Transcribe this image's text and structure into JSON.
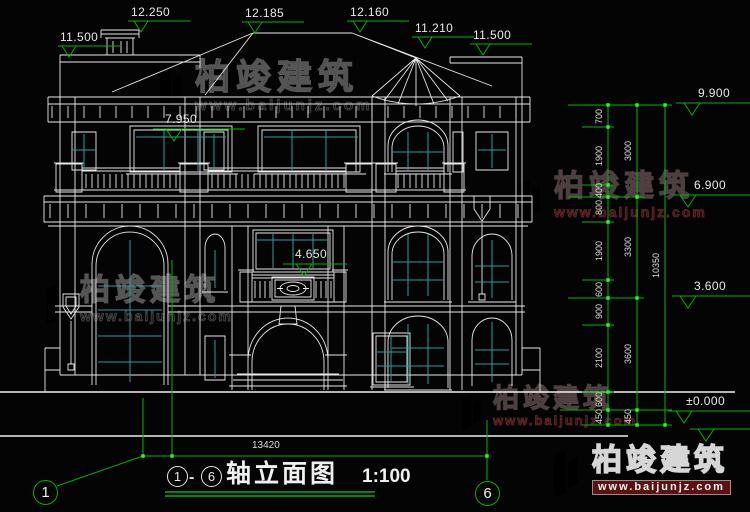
{
  "drawing": {
    "title": {
      "axis_start": "1",
      "separator": "-",
      "axis_end": "6",
      "text": "轴立面图",
      "scale": "1:100"
    },
    "axes": {
      "left_bubble": "1",
      "right_bubble": "6"
    },
    "overall_width_dim": "13420",
    "elevation_markers": {
      "top": [
        "11.500",
        "12.250",
        "12.185",
        "12.160",
        "11.210",
        "11.500"
      ],
      "right": [
        "9.900",
        "6.900",
        "3.600",
        "±0.000"
      ],
      "interior": [
        "7.950",
        "4.650"
      ]
    },
    "right_dim_chain": {
      "col1": [
        "700",
        "1900",
        "400",
        "800",
        "1900",
        "600",
        "900",
        "2100",
        "600",
        "450"
      ],
      "col2": [
        "3000",
        "3300",
        "3600",
        "450"
      ],
      "col3": [
        "10350"
      ]
    }
  },
  "watermark": {
    "brand": "柏竣建筑",
    "url": "www.baijunjz.com"
  },
  "colors": {
    "line": "#e8e8e8",
    "glass": "#2a9d9d",
    "dim_green": "#00b400",
    "tick_green": "#2cf32c"
  }
}
